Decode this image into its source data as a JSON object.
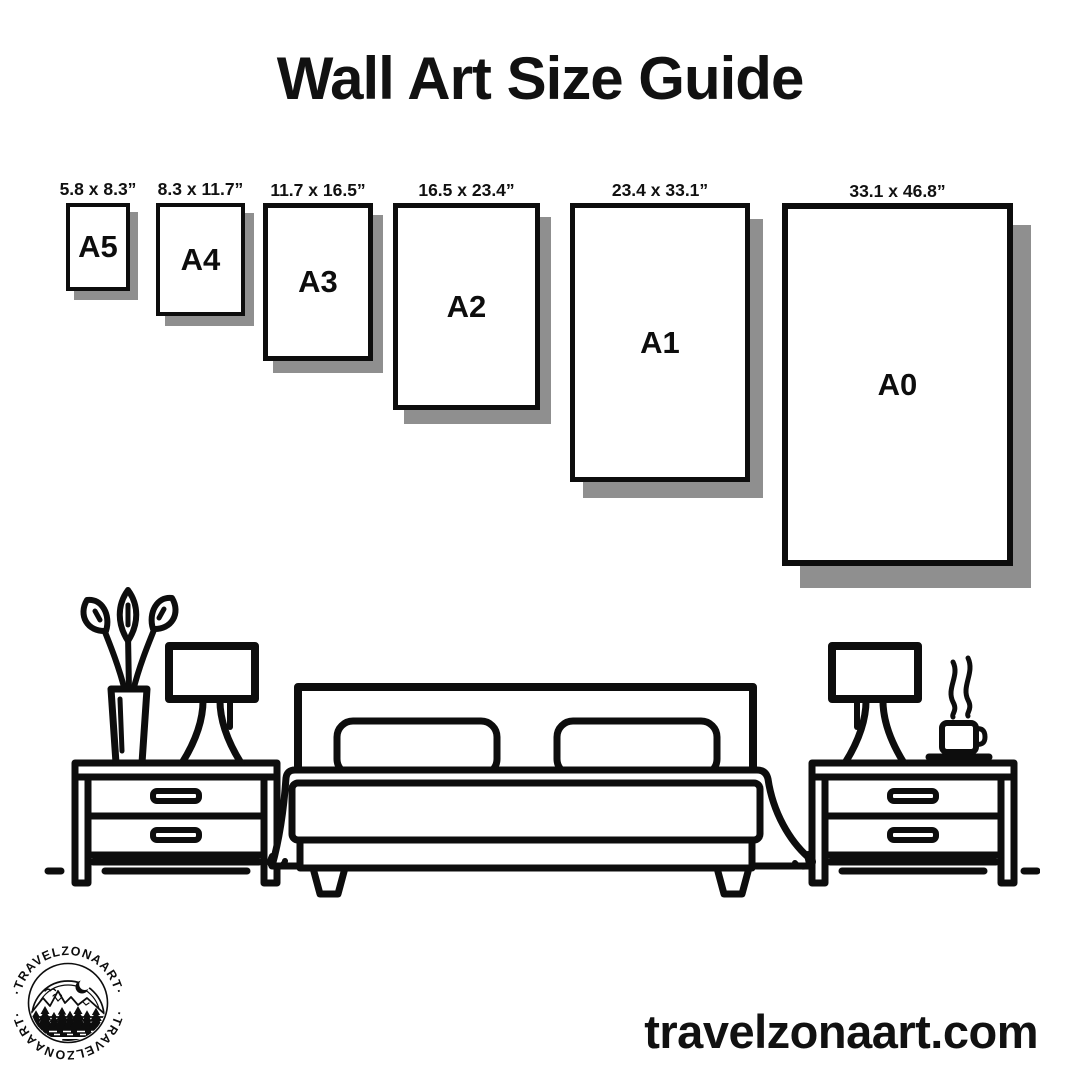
{
  "title": "Wall Art Size Guide",
  "papers": [
    {
      "name": "A5",
      "dimensions": "5.8 x 8.3”"
    },
    {
      "name": "A4",
      "dimensions": "8.3 x 11.7”"
    },
    {
      "name": "A3",
      "dimensions": "11.7 x 16.5”"
    },
    {
      "name": "A2",
      "dimensions": "16.5 x 23.4”"
    },
    {
      "name": "A1",
      "dimensions": "23.4 x 33.1”"
    },
    {
      "name": "A0",
      "dimensions": "33.1 x 46.8”"
    }
  ],
  "scene": {
    "items": [
      "nightstand-left",
      "plant-vase",
      "table-lamp-left",
      "bed-with-pillows",
      "nightstand-right",
      "table-lamp-right",
      "coffee-cup-steaming",
      "floor-line"
    ]
  },
  "logo": {
    "text_top": "·TRAVELZONAART·",
    "text_bottom": "·TRAVELZONAART·"
  },
  "website": "travelzonaart.com",
  "colors": {
    "ink": "#0d0d0d",
    "shadow": "#8f8f8f",
    "background": "#ffffff"
  }
}
